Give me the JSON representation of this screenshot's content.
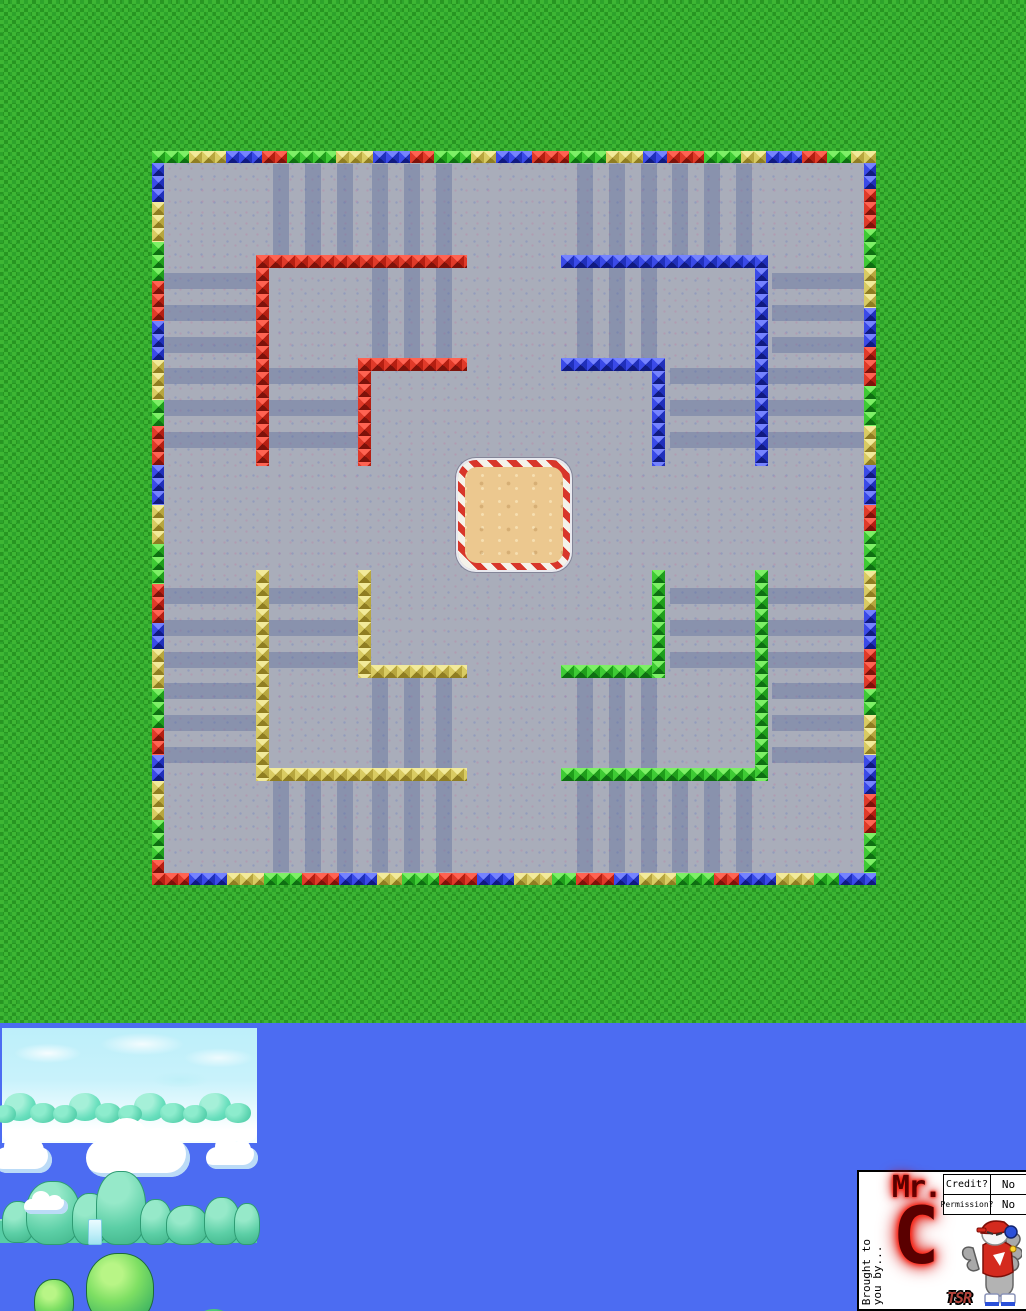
{
  "page": {
    "width": 1026,
    "height": 1311
  },
  "colors": {
    "grass": "#2da32b",
    "grass_check": "#3db633",
    "arena_floor": "#a9adba",
    "floor_stripe": "#58669880",
    "sky_blue": "#4c6cf2",
    "pale_sky_tile": "#bdeffa",
    "sand": "#ecc88f",
    "candy_red": "#d8362a",
    "candy_white": "#f4f2ea",
    "tile_red": "#e03a29",
    "tile_green": "#3ecb34",
    "tile_blue": "#3a4ae8",
    "tile_yellow": "#d9cb62",
    "logo_red": "#e80d00"
  },
  "arena": {
    "x": 152,
    "y": 151,
    "w": 724,
    "h": 734,
    "border_thickness": 12,
    "sand": [
      306,
      309,
      112,
      110
    ],
    "border": {
      "top": [
        [
          "green",
          3
        ],
        [
          "yellow",
          3
        ],
        [
          "blue",
          3
        ],
        [
          "red",
          2
        ],
        [
          "green",
          4
        ],
        [
          "yellow",
          3
        ],
        [
          "blue",
          3
        ],
        [
          "red",
          2
        ],
        [
          "green",
          3
        ],
        [
          "yellow",
          2
        ],
        [
          "blue",
          3
        ],
        [
          "red",
          3
        ],
        [
          "green",
          3
        ],
        [
          "yellow",
          3
        ],
        [
          "blue",
          2
        ],
        [
          "red",
          3
        ],
        [
          "green",
          3
        ],
        [
          "yellow",
          2
        ],
        [
          "blue",
          3
        ],
        [
          "red",
          2
        ],
        [
          "green",
          2
        ],
        [
          "yellow",
          2
        ]
      ],
      "bottom": [
        [
          "red",
          3
        ],
        [
          "blue",
          3
        ],
        [
          "yellow",
          3
        ],
        [
          "green",
          3
        ],
        [
          "red",
          3
        ],
        [
          "blue",
          3
        ],
        [
          "yellow",
          2
        ],
        [
          "green",
          3
        ],
        [
          "red",
          3
        ],
        [
          "blue",
          3
        ],
        [
          "yellow",
          3
        ],
        [
          "green",
          2
        ],
        [
          "red",
          3
        ],
        [
          "blue",
          2
        ],
        [
          "yellow",
          3
        ],
        [
          "green",
          3
        ],
        [
          "red",
          2
        ],
        [
          "blue",
          3
        ],
        [
          "yellow",
          3
        ],
        [
          "green",
          2
        ],
        [
          "blue",
          3
        ]
      ],
      "left": [
        [
          "blue",
          3
        ],
        [
          "yellow",
          3
        ],
        [
          "green",
          3
        ],
        [
          "red",
          3
        ],
        [
          "blue",
          3
        ],
        [
          "yellow",
          3
        ],
        [
          "green",
          2
        ],
        [
          "red",
          3
        ],
        [
          "blue",
          3
        ],
        [
          "yellow",
          3
        ],
        [
          "green",
          3
        ],
        [
          "red",
          3
        ],
        [
          "blue",
          2
        ],
        [
          "yellow",
          3
        ],
        [
          "green",
          3
        ],
        [
          "red",
          2
        ],
        [
          "blue",
          2
        ],
        [
          "yellow",
          3
        ],
        [
          "green",
          3
        ],
        [
          "red",
          1
        ]
      ],
      "right": [
        [
          "blue",
          2
        ],
        [
          "red",
          3
        ],
        [
          "green",
          3
        ],
        [
          "yellow",
          3
        ],
        [
          "blue",
          3
        ],
        [
          "red",
          3
        ],
        [
          "green",
          3
        ],
        [
          "yellow",
          3
        ],
        [
          "blue",
          3
        ],
        [
          "red",
          2
        ],
        [
          "green",
          3
        ],
        [
          "yellow",
          3
        ],
        [
          "blue",
          3
        ],
        [
          "red",
          3
        ],
        [
          "green",
          2
        ],
        [
          "yellow",
          3
        ],
        [
          "blue",
          3
        ],
        [
          "red",
          3
        ],
        [
          "green",
          3
        ]
      ]
    },
    "walls": [
      {
        "color": "red",
        "rects": [
          [
            104,
            104,
            211,
            13
          ],
          [
            104,
            104,
            13,
            211
          ],
          [
            206,
            207,
            109,
            13
          ],
          [
            206,
            207,
            13,
            108
          ]
        ]
      },
      {
        "color": "blue",
        "rects": [
          [
            409,
            104,
            207,
            13
          ],
          [
            603,
            104,
            13,
            211
          ],
          [
            409,
            207,
            104,
            13
          ],
          [
            500,
            207,
            13,
            108
          ]
        ]
      },
      {
        "color": "yellow",
        "rects": [
          [
            104,
            617,
            211,
            13
          ],
          [
            104,
            419,
            13,
            211
          ],
          [
            206,
            514,
            109,
            13
          ],
          [
            206,
            419,
            13,
            108
          ]
        ]
      },
      {
        "color": "green",
        "rects": [
          [
            409,
            617,
            207,
            13
          ],
          [
            603,
            419,
            13,
            211
          ],
          [
            409,
            514,
            104,
            13
          ],
          [
            500,
            419,
            13,
            108
          ]
        ]
      }
    ],
    "stripes": [
      [
        121,
        13,
        16,
        91
      ],
      [
        153,
        13,
        16,
        91
      ],
      [
        185,
        13,
        16,
        91
      ],
      [
        220,
        13,
        16,
        194
      ],
      [
        252,
        13,
        16,
        194
      ],
      [
        284,
        13,
        16,
        194
      ],
      [
        12,
        122,
        92,
        16
      ],
      [
        12,
        154,
        92,
        16
      ],
      [
        12,
        186,
        92,
        16
      ],
      [
        12,
        217,
        194,
        16
      ],
      [
        12,
        249,
        194,
        16
      ],
      [
        12,
        281,
        194,
        16
      ],
      [
        425,
        13,
        16,
        194
      ],
      [
        457,
        13,
        16,
        194
      ],
      [
        489,
        13,
        16,
        194
      ],
      [
        520,
        13,
        16,
        91
      ],
      [
        552,
        13,
        16,
        91
      ],
      [
        584,
        13,
        16,
        91
      ],
      [
        620,
        122,
        92,
        16
      ],
      [
        620,
        154,
        92,
        16
      ],
      [
        620,
        186,
        92,
        16
      ],
      [
        518,
        217,
        194,
        16
      ],
      [
        518,
        249,
        194,
        16
      ],
      [
        518,
        281,
        194,
        16
      ],
      [
        121,
        630,
        16,
        91
      ],
      [
        153,
        630,
        16,
        91
      ],
      [
        185,
        630,
        16,
        91
      ],
      [
        220,
        527,
        16,
        194
      ],
      [
        252,
        527,
        16,
        194
      ],
      [
        284,
        527,
        16,
        194
      ],
      [
        12,
        596,
        92,
        16
      ],
      [
        12,
        564,
        92,
        16
      ],
      [
        12,
        532,
        92,
        16
      ],
      [
        12,
        437,
        194,
        16
      ],
      [
        12,
        469,
        194,
        16
      ],
      [
        12,
        501,
        194,
        16
      ],
      [
        425,
        527,
        16,
        194
      ],
      [
        457,
        527,
        16,
        194
      ],
      [
        489,
        527,
        16,
        194
      ],
      [
        520,
        630,
        16,
        91
      ],
      [
        552,
        630,
        16,
        91
      ],
      [
        584,
        630,
        16,
        91
      ],
      [
        620,
        532,
        92,
        16
      ],
      [
        620,
        564,
        92,
        16
      ],
      [
        620,
        596,
        92,
        16
      ],
      [
        518,
        437,
        194,
        16
      ],
      [
        518,
        469,
        194,
        16
      ],
      [
        518,
        501,
        194,
        16
      ]
    ]
  },
  "sky_band": {
    "decor": [
      {
        "type": "skystrip",
        "x": 2,
        "y": 5,
        "w": 255,
        "h": 115
      },
      {
        "type": "fog",
        "x": 2,
        "y": 92,
        "w": 255,
        "h": 26
      },
      {
        "type": "bump",
        "x": 4,
        "y": 70,
        "w": 32,
        "h": 28
      },
      {
        "type": "bump2",
        "x": -6,
        "y": 82,
        "w": 22,
        "h": 18
      },
      {
        "type": "bump2",
        "x": 30,
        "y": 80,
        "w": 26,
        "h": 20
      },
      {
        "type": "bump",
        "x": 69,
        "y": 70,
        "w": 32,
        "h": 28
      },
      {
        "type": "bump2",
        "x": 53,
        "y": 82,
        "w": 24,
        "h": 18
      },
      {
        "type": "bump2",
        "x": 95,
        "y": 80,
        "w": 26,
        "h": 20
      },
      {
        "type": "bump",
        "x": 134,
        "y": 70,
        "w": 32,
        "h": 28
      },
      {
        "type": "bump2",
        "x": 118,
        "y": 82,
        "w": 24,
        "h": 18
      },
      {
        "type": "bump2",
        "x": 160,
        "y": 80,
        "w": 26,
        "h": 20
      },
      {
        "type": "bump",
        "x": 199,
        "y": 70,
        "w": 32,
        "h": 28
      },
      {
        "type": "bump2",
        "x": 183,
        "y": 82,
        "w": 24,
        "h": 18
      },
      {
        "type": "bump2",
        "x": 225,
        "y": 80,
        "w": 26,
        "h": 20
      },
      {
        "type": "cloud",
        "x": -6,
        "y": 124,
        "w": 58,
        "h": 26
      },
      {
        "type": "cloud",
        "x": 86,
        "y": 116,
        "w": 104,
        "h": 38
      },
      {
        "type": "cloud",
        "x": 206,
        "y": 124,
        "w": 52,
        "h": 22
      },
      {
        "type": "hillbase",
        "x": 0,
        "y": 196,
        "w": 257,
        "h": 22
      },
      {
        "type": "hill",
        "x": 2,
        "y": 178,
        "w": 30,
        "h": 40
      },
      {
        "type": "hill",
        "x": 26,
        "y": 158,
        "w": 52,
        "h": 62
      },
      {
        "type": "hill",
        "x": 72,
        "y": 170,
        "w": 34,
        "h": 50
      },
      {
        "type": "hill",
        "x": 96,
        "y": 148,
        "w": 48,
        "h": 72
      },
      {
        "type": "hill",
        "x": 140,
        "y": 176,
        "w": 30,
        "h": 44
      },
      {
        "type": "hill",
        "x": 166,
        "y": 182,
        "w": 40,
        "h": 38
      },
      {
        "type": "hill",
        "x": 204,
        "y": 174,
        "w": 34,
        "h": 46
      },
      {
        "type": "hill",
        "x": 234,
        "y": 180,
        "w": 24,
        "h": 40
      },
      {
        "type": "waterfall",
        "x": 88,
        "y": 196,
        "w": 12,
        "h": 24
      },
      {
        "type": "cloud",
        "x": 24,
        "y": 176,
        "w": 44,
        "h": 15
      },
      {
        "type": "trunk",
        "x": 108,
        "y": 286,
        "w": 20,
        "h": 20
      },
      {
        "type": "trunk",
        "x": 46,
        "y": 290,
        "w": 12,
        "h": 14
      },
      {
        "type": "tree",
        "x": 86,
        "y": 230,
        "w": 66,
        "h": 72
      },
      {
        "type": "tree",
        "x": 34,
        "y": 256,
        "w": 38,
        "h": 46
      },
      {
        "type": "root",
        "x": 14,
        "y": 286,
        "w": 74,
        "h": 22,
        "rot": -6
      },
      {
        "type": "root",
        "x": 92,
        "y": 278,
        "w": 86,
        "h": 30,
        "rot": 5
      },
      {
        "type": "root",
        "x": 150,
        "y": 292,
        "w": 54,
        "h": 14,
        "rot": -4
      },
      {
        "type": "root",
        "x": 214,
        "y": 292,
        "w": 44,
        "h": 14,
        "rot": 8
      },
      {
        "type": "root",
        "x": 58,
        "y": 296,
        "w": 40,
        "h": 12,
        "rot": -10
      },
      {
        "type": "bush",
        "x": -4,
        "y": 290,
        "w": 30,
        "h": 22
      },
      {
        "type": "bush",
        "x": 18,
        "y": 296,
        "w": 24,
        "h": 16
      },
      {
        "type": "bush",
        "x": 142,
        "y": 288,
        "w": 34,
        "h": 24
      },
      {
        "type": "bush",
        "x": 170,
        "y": 292,
        "w": 30,
        "h": 20
      },
      {
        "type": "bush",
        "x": 196,
        "y": 286,
        "w": 36,
        "h": 26
      },
      {
        "type": "bush",
        "x": 228,
        "y": 290,
        "w": 32,
        "h": 22
      },
      {
        "type": "bush",
        "x": 250,
        "y": 294,
        "w": 20,
        "h": 16
      }
    ]
  },
  "credit_panel": {
    "brought_by": "Brought to\nyou by...",
    "logo_line1": "Mr.",
    "logo_line2": "C",
    "tsr": "TSR",
    "table": {
      "rows": [
        {
          "label": "Credit?",
          "value": "No"
        },
        {
          "label": "Permission?",
          "value": "No"
        }
      ]
    }
  }
}
